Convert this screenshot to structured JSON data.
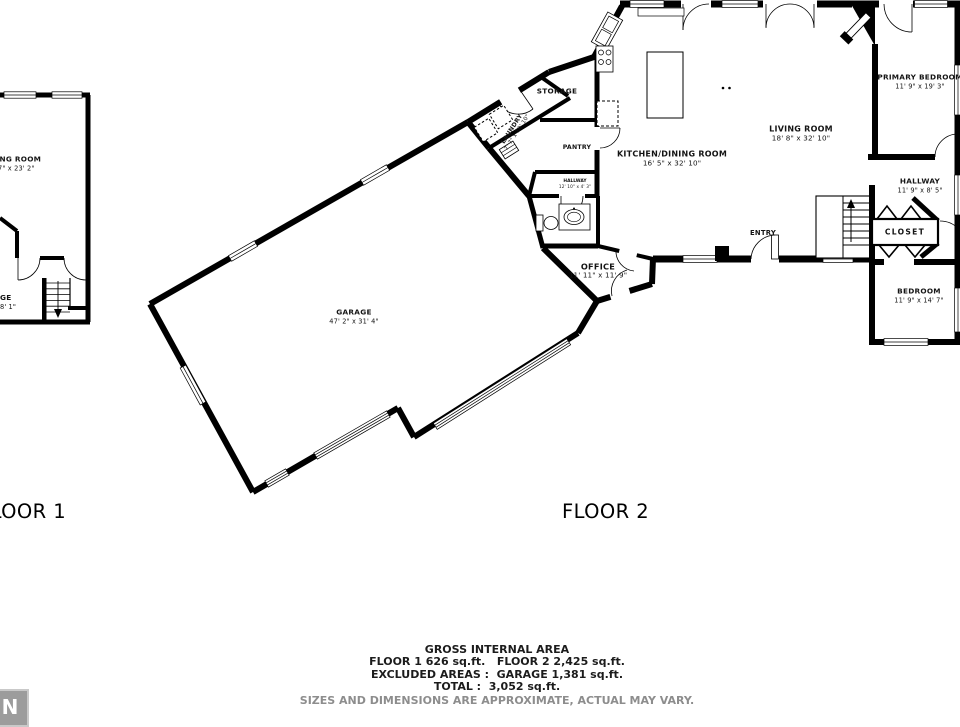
{
  "colors": {
    "wall": "#000000",
    "background": "#ffffff",
    "disclaimer_text": "#8d8d8d",
    "compass_bg": "#9c9c9c"
  },
  "floors": {
    "floor1": {
      "label": "FLOOR 1"
    },
    "floor2": {
      "label": "FLOOR 2"
    }
  },
  "rooms": {
    "floor1_living": {
      "name": "LIVING ROOM",
      "dims": "9' 7\" x 23' 2\""
    },
    "floor1_partial": {
      "name": "GE",
      "dims": "8' 1\""
    },
    "garage": {
      "name": "GARAGE",
      "dims": "47' 2\" x 31' 4\""
    },
    "storage": {
      "name": "STORAGE"
    },
    "laundry": {
      "name": "LAUNDRY",
      "dims": "7' 7\" x 10' 10\""
    },
    "pantry": {
      "name": "PANTRY"
    },
    "hallway_small": {
      "name": "HALLWAY",
      "dims": "12' 10\" x 4' 3\""
    },
    "office": {
      "name": "OFFICE",
      "dims": "11' 11\" x 11' 9\""
    },
    "kitchen_dining": {
      "name": "KITCHEN/DINING ROOM",
      "dims": "16' 5\" x 32' 10\""
    },
    "living": {
      "name": "LIVING ROOM",
      "dims": "18' 8\" x 32' 10\""
    },
    "entry": {
      "name": "ENTRY"
    },
    "primary_bedroom": {
      "name": "PRIMARY BEDROOM",
      "dims": "11' 9\" x 19' 3\""
    },
    "hallway": {
      "name": "HALLWAY",
      "dims": "11' 9\" x 8' 5\""
    },
    "closet": {
      "name": "CLOSET"
    },
    "bedroom": {
      "name": "BEDROOM",
      "dims": "11' 9\" x 14' 7\""
    }
  },
  "summary": {
    "title": "GROSS INTERNAL AREA",
    "floor_areas": "FLOOR 1 626 sq.ft.   FLOOR 2 2,425 sq.ft.",
    "excluded_areas": "EXCLUDED AREAS :  GARAGE 1,381 sq.ft.",
    "total": "TOTAL :  3,052 sq.ft.",
    "disclaimer": "SIZES AND DIMENSIONS ARE APPROXIMATE, ACTUAL MAY VARY."
  },
  "compass": {
    "label": "N"
  }
}
